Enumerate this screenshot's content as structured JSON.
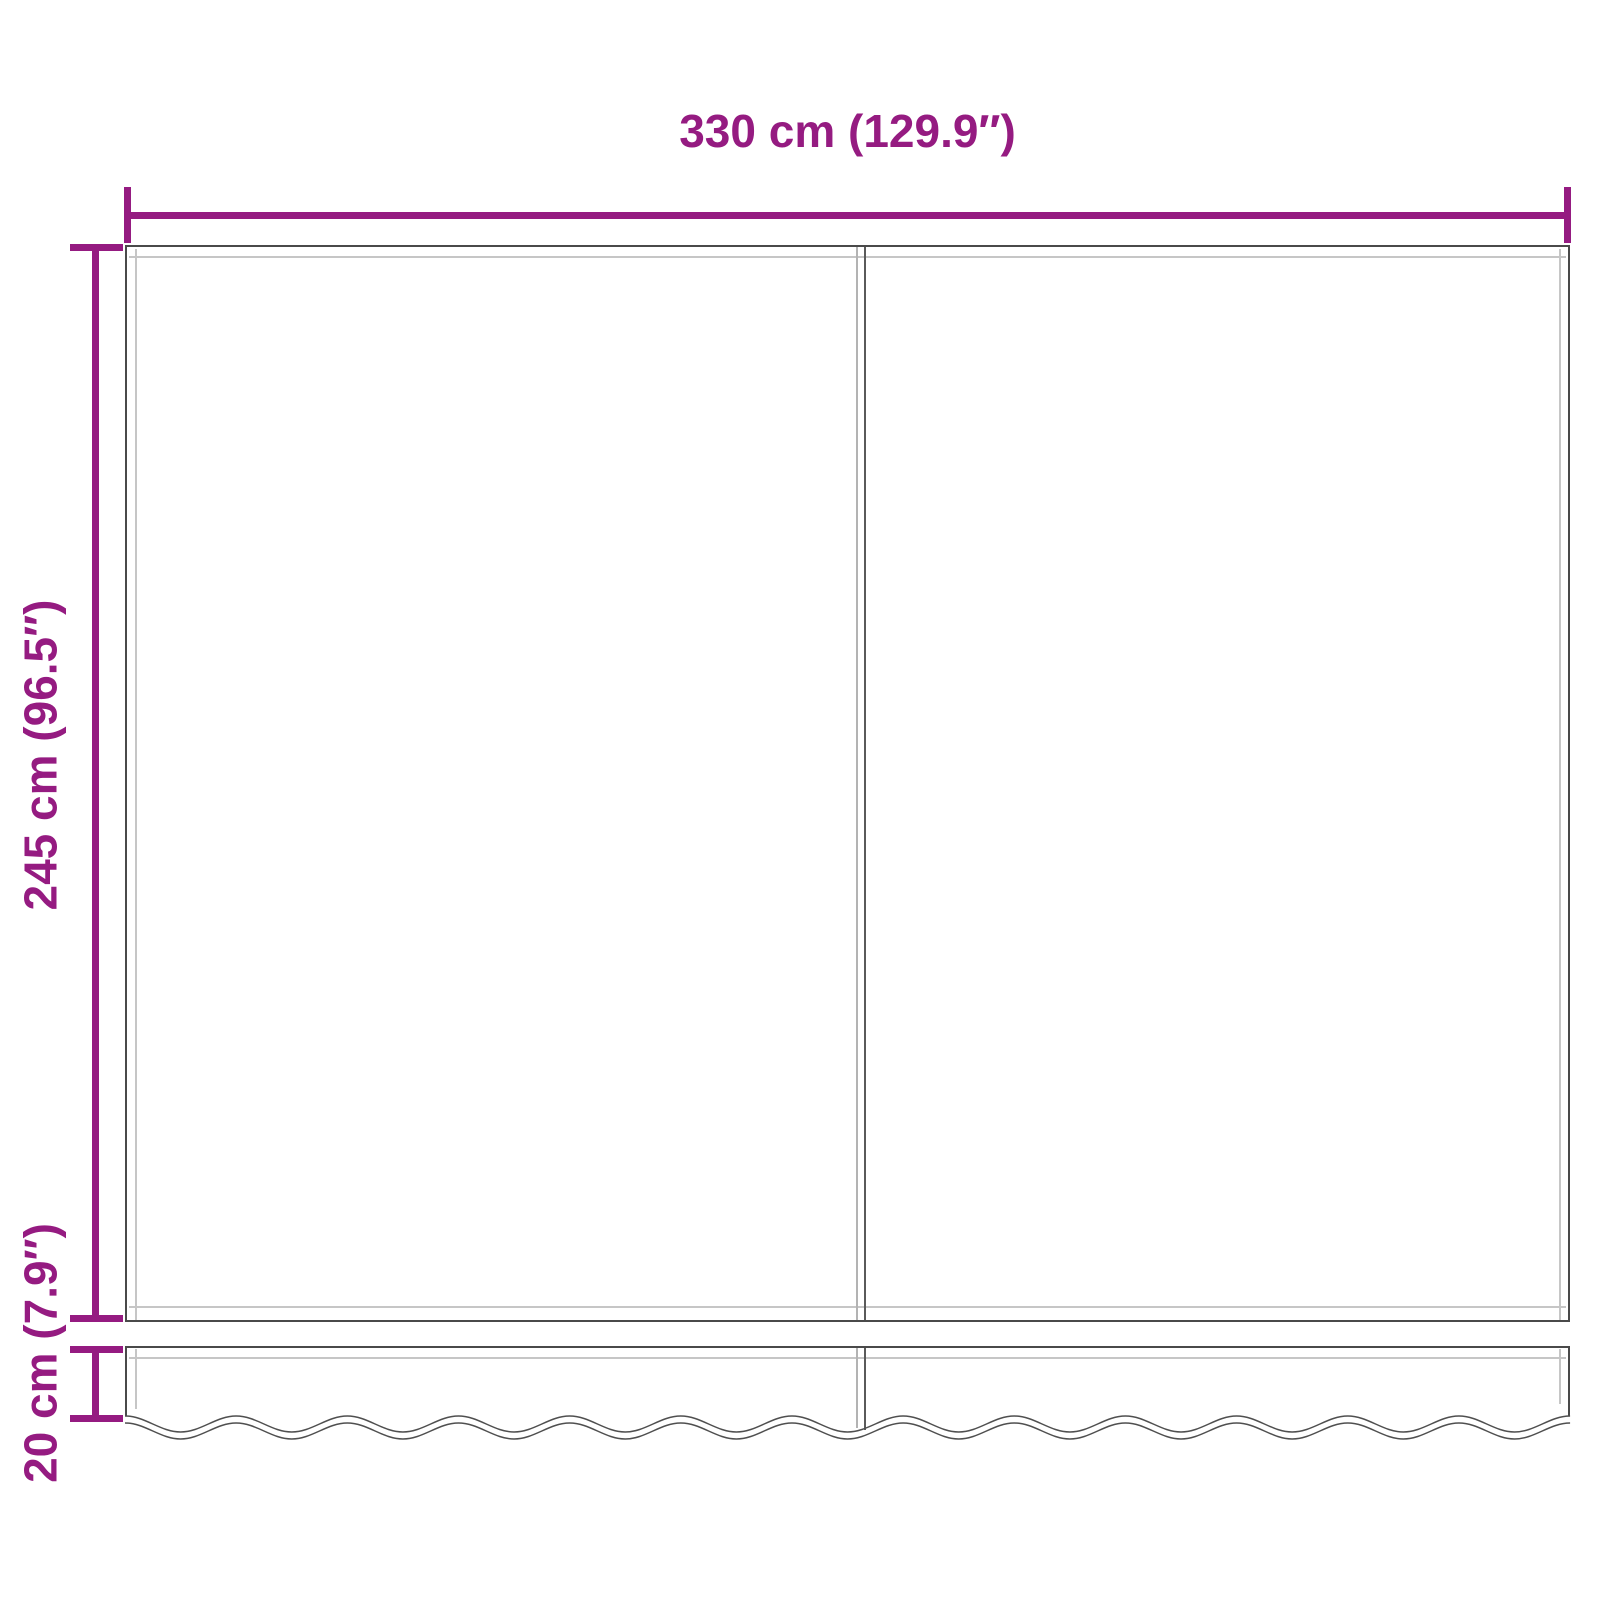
{
  "labels": {
    "width": "330 cm (129.9″)",
    "height": "245 cm (96.5″)",
    "valance_height": "20 cm (7.9″)"
  },
  "measurements": {
    "width_cm": 330,
    "width_inches": 129.9,
    "height_cm": 245,
    "height_inches": 96.5,
    "valance_height_cm": 20,
    "valance_height_inches": 7.9
  },
  "colors": {
    "dimension_accent": "#951B81",
    "outline_dark": "#4A4A4A",
    "outline_light": "#C6C6C6",
    "background": "#FFFFFF"
  }
}
